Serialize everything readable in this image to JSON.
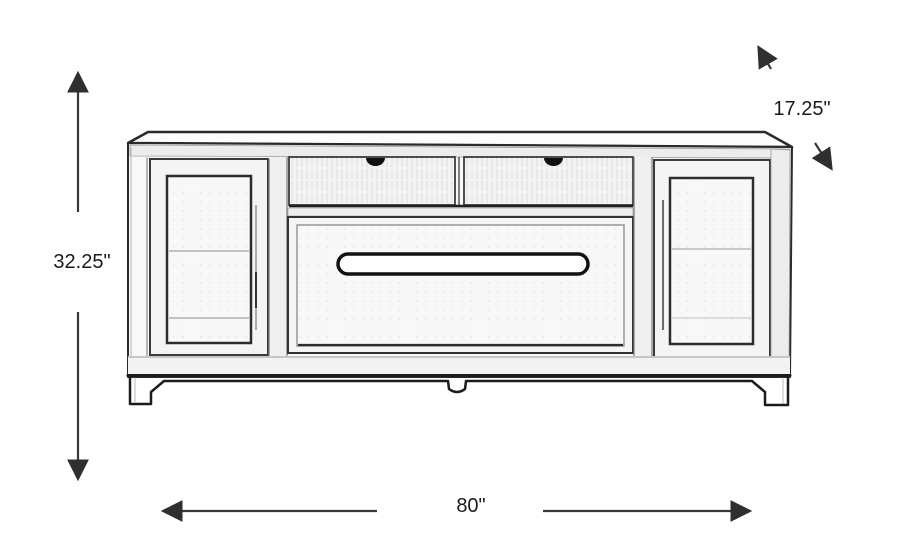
{
  "diagram": {
    "subject": "tv-console-sketch",
    "labels": {
      "height": "32.25\"",
      "depth": "17.25\"",
      "width": "80\""
    },
    "colors": {
      "background": "#ffffff",
      "line_art": "#2a2a2a",
      "dimension_lines": "#383838",
      "label_text": "#1b1b1b"
    }
  }
}
